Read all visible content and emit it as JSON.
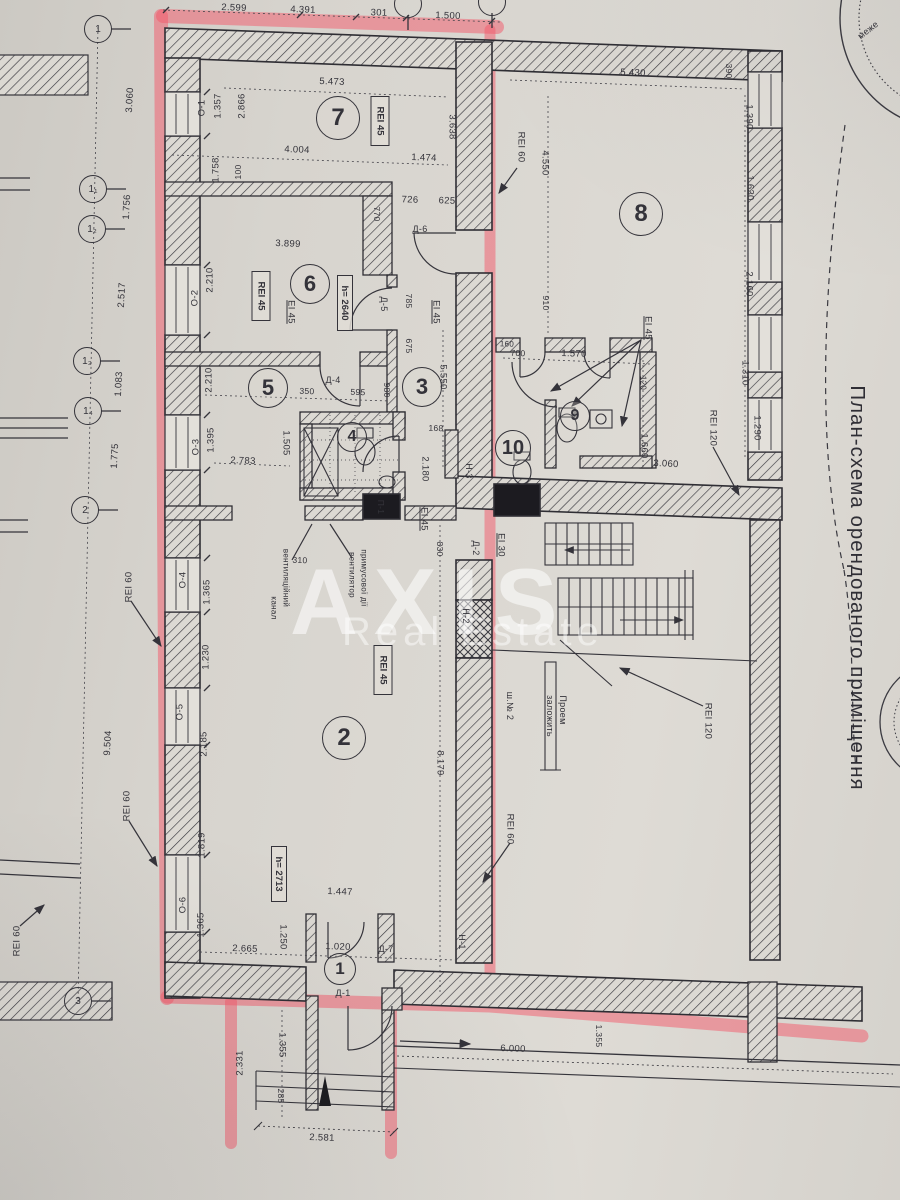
{
  "title": "План-схема орендованого приміщення",
  "watermark": {
    "line1": "AXIS",
    "line2": "Real Estate"
  },
  "colors": {
    "paper": "#d8d5cf",
    "ink": "#34333a",
    "highlight": "#f4586a"
  },
  "plan": {
    "rooms": [
      {
        "n": "7",
        "x": 338,
        "y": 118,
        "r": 21
      },
      {
        "n": "6",
        "x": 310,
        "y": 284,
        "r": 19
      },
      {
        "n": "5",
        "x": 268,
        "y": 388,
        "r": 19
      },
      {
        "n": "3",
        "x": 422,
        "y": 387,
        "r": 19
      },
      {
        "n": "4",
        "x": 352,
        "y": 437,
        "r": 14
      },
      {
        "n": "2",
        "x": 344,
        "y": 738,
        "r": 21
      },
      {
        "n": "1",
        "x": 340,
        "y": 969,
        "r": 15
      },
      {
        "n": "8",
        "x": 641,
        "y": 214,
        "r": 21
      },
      {
        "n": "9",
        "x": 575,
        "y": 416,
        "r": 14
      },
      {
        "n": "10",
        "x": 513,
        "y": 448,
        "r": 17
      }
    ],
    "axes": [
      {
        "n": "1",
        "x": 98,
        "y": 29
      },
      {
        "n": "1₁",
        "x": 93,
        "y": 189
      },
      {
        "n": "1₂",
        "x": 92,
        "y": 229
      },
      {
        "n": "1₃",
        "x": 87,
        "y": 361
      },
      {
        "n": "1₄",
        "x": 88,
        "y": 411
      },
      {
        "n": "2",
        "x": 85,
        "y": 510
      },
      {
        "n": "3",
        "x": 78,
        "y": 1001
      },
      {
        "n": "",
        "x": 408,
        "y": 4
      },
      {
        "n": "",
        "x": 492,
        "y": 2
      }
    ],
    "boxes": [
      {
        "t": "REI 45",
        "x": 380,
        "y": 121,
        "w": 48,
        "h": 17
      },
      {
        "t": "REI 45",
        "x": 261,
        "y": 296,
        "w": 48,
        "h": 17
      },
      {
        "t": "h= 2640",
        "x": 345,
        "y": 303,
        "w": 54,
        "h": 14
      },
      {
        "t": "REI 45",
        "x": 383,
        "y": 670,
        "w": 48,
        "h": 17
      },
      {
        "t": "h= 2713",
        "x": 279,
        "y": 874,
        "w": 54,
        "h": 14
      }
    ],
    "labels": [
      {
        "t": "2.599",
        "x": 234,
        "y": 8
      },
      {
        "t": "4.391",
        "x": 303,
        "y": 10
      },
      {
        "t": "301",
        "x": 379,
        "y": 13
      },
      {
        "t": "1.500",
        "x": 448,
        "y": 16
      },
      {
        "t": "5.473",
        "x": 332,
        "y": 82
      },
      {
        "t": "4.004",
        "x": 297,
        "y": 150
      },
      {
        "t": "1.474",
        "x": 424,
        "y": 158
      },
      {
        "t": "3.638",
        "x": 452,
        "y": 127,
        "r": 90
      },
      {
        "t": "1.357",
        "x": 218,
        "y": 106,
        "r": -90
      },
      {
        "t": "2.866",
        "x": 242,
        "y": 106,
        "r": -90
      },
      {
        "t": "О-1",
        "x": 202,
        "y": 108,
        "r": -90
      },
      {
        "t": "1.758",
        "x": 216,
        "y": 170,
        "r": -90
      },
      {
        "t": "100",
        "x": 238,
        "y": 172,
        "r": -90,
        "s": 8.5
      },
      {
        "t": "770",
        "x": 377,
        "y": 214,
        "r": 90,
        "s": 8.5
      },
      {
        "t": "726",
        "x": 410,
        "y": 200
      },
      {
        "t": "625",
        "x": 447,
        "y": 201
      },
      {
        "t": "Д-6",
        "x": 420,
        "y": 229,
        "r": 0,
        "s": 9
      },
      {
        "t": "3.899",
        "x": 288,
        "y": 244
      },
      {
        "t": "Д-5",
        "x": 384,
        "y": 304,
        "r": 90,
        "s": 9
      },
      {
        "t": "EI 45",
        "x": 291,
        "y": 312,
        "r": 90,
        "u": 1
      },
      {
        "t": "785",
        "x": 409,
        "y": 301,
        "r": 90,
        "s": 8.5
      },
      {
        "t": "675",
        "x": 409,
        "y": 346,
        "r": 90,
        "s": 8.5
      },
      {
        "t": "EI 45",
        "x": 436,
        "y": 312,
        "r": 90,
        "u": 1
      },
      {
        "t": "2.210",
        "x": 210,
        "y": 280,
        "r": -90
      },
      {
        "t": "О-2",
        "x": 195,
        "y": 298,
        "r": -90
      },
      {
        "t": "5.550",
        "x": 443,
        "y": 377,
        "r": 90
      },
      {
        "t": "2.210",
        "x": 209,
        "y": 380,
        "r": -90
      },
      {
        "t": "350",
        "x": 307,
        "y": 391,
        "s": 8.5
      },
      {
        "t": "Д-4",
        "x": 333,
        "y": 380,
        "r": 0,
        "s": 9
      },
      {
        "t": "595",
        "x": 358,
        "y": 392,
        "s": 8.5
      },
      {
        "t": "980",
        "x": 387,
        "y": 390,
        "r": 90,
        "s": 8.5
      },
      {
        "t": "1.395",
        "x": 211,
        "y": 440,
        "r": -90
      },
      {
        "t": "1.505",
        "x": 286,
        "y": 443,
        "r": 90
      },
      {
        "t": "2.783",
        "x": 243,
        "y": 461
      },
      {
        "t": "О-3",
        "x": 196,
        "y": 447,
        "r": -90
      },
      {
        "t": "168",
        "x": 436,
        "y": 428,
        "s": 8.5
      },
      {
        "t": "2.180",
        "x": 425,
        "y": 469,
        "r": 90
      },
      {
        "t": "Н-3",
        "x": 469,
        "y": 471,
        "r": 90,
        "s": 9
      },
      {
        "t": "EI 45",
        "x": 424,
        "y": 519,
        "r": 90,
        "u": 1
      },
      {
        "t": "П-1",
        "x": 381,
        "y": 507,
        "r": 90,
        "s": 8.5
      },
      {
        "t": "EI 30",
        "x": 501,
        "y": 545,
        "r": 90,
        "u": 1
      },
      {
        "t": "830",
        "x": 440,
        "y": 549,
        "r": 90,
        "s": 8.5
      },
      {
        "t": "Д-2",
        "x": 476,
        "y": 548,
        "r": 90,
        "s": 9
      },
      {
        "t": "Н-2",
        "x": 466,
        "y": 616,
        "r": 90,
        "s": 9
      },
      {
        "t": "310",
        "x": 300,
        "y": 560,
        "s": 8.5
      },
      {
        "t": "вентиляційний",
        "x": 286,
        "y": 578,
        "r": 90,
        "s": 8
      },
      {
        "t": "канал",
        "x": 274,
        "y": 608,
        "r": 90,
        "s": 8
      },
      {
        "t": "вентилятор",
        "x": 352,
        "y": 575,
        "r": 90,
        "s": 8
      },
      {
        "t": "примусової дії",
        "x": 364,
        "y": 578,
        "r": 90,
        "s": 8
      },
      {
        "t": "1.365",
        "x": 207,
        "y": 592,
        "r": -90
      },
      {
        "t": "О-4",
        "x": 183,
        "y": 580,
        "r": -90
      },
      {
        "t": "1.230",
        "x": 206,
        "y": 657,
        "r": -90
      },
      {
        "t": "2.185",
        "x": 204,
        "y": 744,
        "r": -90
      },
      {
        "t": "О-5",
        "x": 180,
        "y": 712,
        "r": -90
      },
      {
        "t": "1.819",
        "x": 202,
        "y": 845,
        "r": -90
      },
      {
        "t": "1.365",
        "x": 201,
        "y": 925,
        "r": -90
      },
      {
        "t": "О-6",
        "x": 183,
        "y": 905,
        "r": -90
      },
      {
        "t": "1.447",
        "x": 340,
        "y": 892
      },
      {
        "t": "1.250",
        "x": 283,
        "y": 937,
        "r": 90
      },
      {
        "t": "2.665",
        "x": 245,
        "y": 949
      },
      {
        "t": "1.020",
        "x": 338,
        "y": 947
      },
      {
        "t": "Д-7",
        "x": 386,
        "y": 949,
        "r": 0,
        "s": 9
      },
      {
        "t": "Н-1",
        "x": 462,
        "y": 942,
        "r": 90,
        "s": 9
      },
      {
        "t": "8.179",
        "x": 440,
        "y": 763,
        "r": 90
      },
      {
        "t": "Д-1",
        "x": 343,
        "y": 993,
        "r": 0,
        "s": 9
      },
      {
        "t": "1.355",
        "x": 282,
        "y": 1045,
        "r": 90
      },
      {
        "t": "2.331",
        "x": 240,
        "y": 1063,
        "r": -90
      },
      {
        "t": "285",
        "x": 281,
        "y": 1096,
        "r": 90,
        "s": 8.5
      },
      {
        "t": "2.581",
        "x": 322,
        "y": 1138
      },
      {
        "t": "6.000",
        "x": 513,
        "y": 1049
      },
      {
        "t": "1.355",
        "x": 599,
        "y": 1036,
        "r": 90,
        "s": 8.5
      },
      {
        "t": "5.430",
        "x": 633,
        "y": 73
      },
      {
        "t": "390",
        "x": 729,
        "y": 71,
        "r": 90,
        "s": 8.5
      },
      {
        "t": "1.390",
        "x": 749,
        "y": 117,
        "r": 90
      },
      {
        "t": "1.630",
        "x": 750,
        "y": 188,
        "r": 90
      },
      {
        "t": "2.160",
        "x": 749,
        "y": 284,
        "r": 90
      },
      {
        "t": "REI 60",
        "x": 521,
        "y": 147,
        "r": 90
      },
      {
        "t": "4.550",
        "x": 545,
        "y": 163,
        "r": 90
      },
      {
        "t": "910",
        "x": 546,
        "y": 303,
        "r": 90,
        "s": 8.5
      },
      {
        "t": "EI 45",
        "x": 648,
        "y": 328,
        "r": 90,
        "u": 1
      },
      {
        "t": "160",
        "x": 507,
        "y": 344,
        "s": 8
      },
      {
        "t": "700",
        "x": 518,
        "y": 353,
        "s": 8.5
      },
      {
        "t": "1.570",
        "x": 574,
        "y": 354
      },
      {
        "t": "120",
        "x": 643,
        "y": 383,
        "r": 90,
        "s": 8
      },
      {
        "t": "1.660",
        "x": 644,
        "y": 446,
        "r": 90
      },
      {
        "t": "3.060",
        "x": 666,
        "y": 464,
        "r": 3
      },
      {
        "t": "REI 120",
        "x": 713,
        "y": 428,
        "r": 90
      },
      {
        "t": "1.310",
        "x": 745,
        "y": 373,
        "r": 90
      },
      {
        "t": "1.290",
        "x": 757,
        "y": 428,
        "r": 90
      },
      {
        "t": "REI 120",
        "x": 708,
        "y": 721,
        "r": 90
      },
      {
        "t": "Проем",
        "x": 563,
        "y": 710,
        "r": 90,
        "s": 9
      },
      {
        "t": "заложить",
        "x": 550,
        "y": 716,
        "r": 90,
        "s": 9
      },
      {
        "t": "ш.№ 2",
        "x": 510,
        "y": 706,
        "r": 90,
        "s": 9
      },
      {
        "t": "3.060",
        "x": 130,
        "y": 100,
        "r": -87
      },
      {
        "t": "1.756",
        "x": 127,
        "y": 207,
        "r": -87
      },
      {
        "t": "2.517",
        "x": 122,
        "y": 295,
        "r": -87
      },
      {
        "t": "1.083",
        "x": 119,
        "y": 384,
        "r": -87
      },
      {
        "t": "1.775",
        "x": 115,
        "y": 456,
        "r": -87
      },
      {
        "t": "9.504",
        "x": 108,
        "y": 743,
        "r": -87
      },
      {
        "t": "REI 60",
        "x": 129,
        "y": 587,
        "r": -90
      },
      {
        "t": "REI 60",
        "x": 127,
        "y": 806,
        "r": -90
      },
      {
        "t": "REI 60",
        "x": 17,
        "y": 941,
        "r": -90
      },
      {
        "t": "REI 60",
        "x": 510,
        "y": 829,
        "r": 90
      },
      {
        "t": "меже",
        "x": 868,
        "y": 30,
        "r": -38,
        "s": 9
      }
    ]
  }
}
